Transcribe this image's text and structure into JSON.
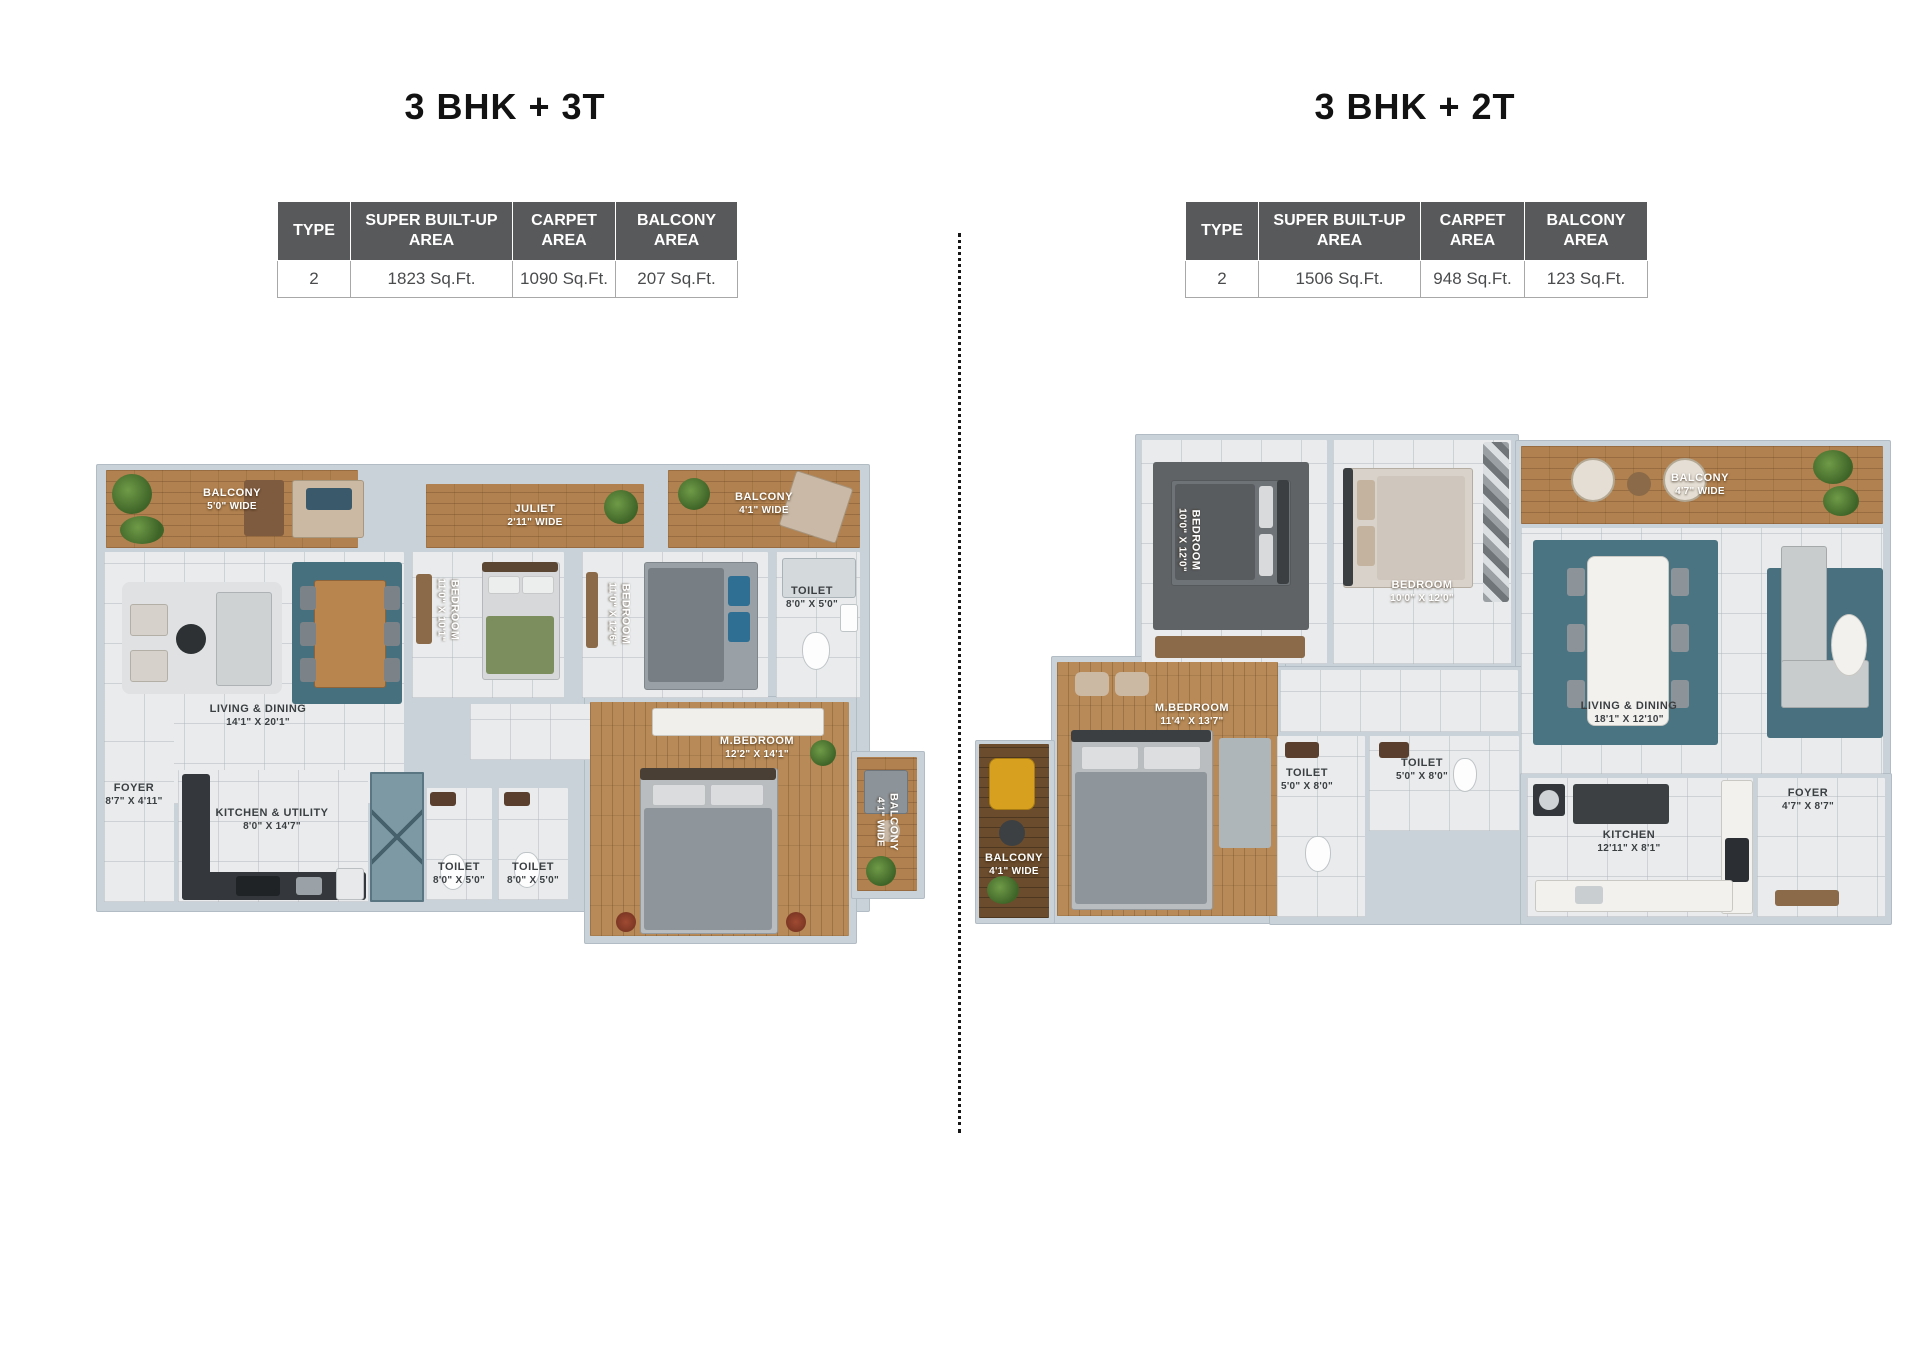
{
  "left": {
    "title": "3 BHK + 3T",
    "table": {
      "headers": [
        "TYPE",
        "SUPER BUILT-UP AREA",
        "CARPET AREA",
        "BALCONY AREA"
      ],
      "row": [
        "2",
        "1823 Sq.Ft.",
        "1090 Sq.Ft.",
        "207 Sq.Ft."
      ]
    },
    "rooms": {
      "balcony_tl": {
        "name": "BALCONY",
        "dims": "5'0\" WIDE"
      },
      "juliet": {
        "name": "JULIET",
        "dims": "2'11\" WIDE"
      },
      "balcony_tr": {
        "name": "BALCONY",
        "dims": "4'1\" WIDE"
      },
      "living": {
        "name": "LIVING & DINING",
        "dims": "14'1\" X 20'1\""
      },
      "bedroom1": {
        "name": "BEDROOM",
        "dims": "11'0\" X 10'1\""
      },
      "bedroom2": {
        "name": "BEDROOM",
        "dims": "11'0\" X 12'6\""
      },
      "toilet_top": {
        "name": "TOILET",
        "dims": "8'0\" X 5'0\""
      },
      "foyer": {
        "name": "FOYER",
        "dims": "8'7\" X 4'11\""
      },
      "kitchen": {
        "name": "KITCHEN & UTILITY",
        "dims": "8'0\" X 14'7\""
      },
      "toilet_b1": {
        "name": "TOILET",
        "dims": "8'0\" X 5'0\""
      },
      "toilet_b2": {
        "name": "TOILET",
        "dims": "8'0\" X 5'0\""
      },
      "mbedroom": {
        "name": "M.BEDROOM",
        "dims": "12'2\" X 14'1\""
      },
      "balcony_br": {
        "name": "BALCONY",
        "dims": "4'1\" WIDE"
      }
    }
  },
  "right": {
    "title": "3 BHK + 2T",
    "table": {
      "headers": [
        "TYPE",
        "SUPER BUILT-UP AREA",
        "CARPET AREA",
        "BALCONY AREA"
      ],
      "row": [
        "2",
        "1506 Sq.Ft.",
        "948 Sq.Ft.",
        "123 Sq.Ft."
      ]
    },
    "rooms": {
      "bedroom_tl": {
        "name": "BEDROOM",
        "dims": "10'0\" X 12'0\""
      },
      "bedroom_tm": {
        "name": "BEDROOM",
        "dims": "10'0\" X 12'0\""
      },
      "balcony_top": {
        "name": "BALCONY",
        "dims": "4'7\" WIDE"
      },
      "living": {
        "name": "LIVING & DINING",
        "dims": "18'1\" X 12'10\""
      },
      "mbedroom": {
        "name": "M.BEDROOM",
        "dims": "11'4\" X 13'7\""
      },
      "toilet1": {
        "name": "TOILET",
        "dims": "5'0\" X 8'0\""
      },
      "toilet2": {
        "name": "TOILET",
        "dims": "5'0\" X 8'0\""
      },
      "kitchen": {
        "name": "KITCHEN",
        "dims": "12'11\" X 8'1\""
      },
      "foyer": {
        "name": "FOYER",
        "dims": "4'7\" X 8'7\""
      },
      "balcony_left": {
        "name": "BALCONY",
        "dims": "4'1\" WIDE"
      }
    }
  },
  "colors": {
    "table_header_bg": "#58595b",
    "wall": "#c9d2d9",
    "tile_floor": "#e9ebec",
    "wood_floor": "#b1814f",
    "dark_wood_floor": "#6b4c2c",
    "teal_rug": "#4b7482",
    "shaft_teal": "#7d99a4",
    "title_text": "#121212"
  }
}
